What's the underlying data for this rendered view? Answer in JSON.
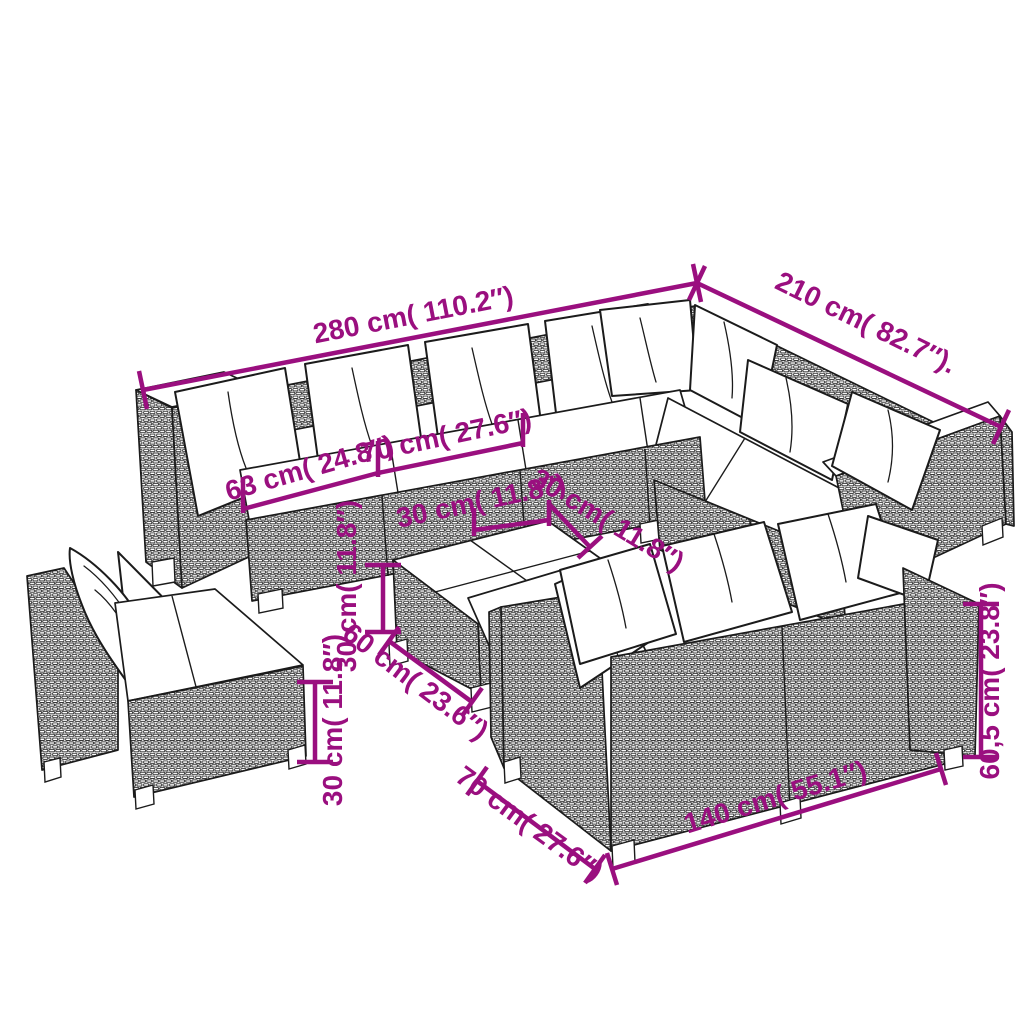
{
  "diagram": {
    "type": "product-dimension-diagram",
    "subject": "garden-lounge-set-poly-rattan",
    "colors": {
      "dimension": "#9a0f7f",
      "outline": "#1b1b1b",
      "cushion": "#ffffff",
      "background": "#ffffff"
    },
    "dims": {
      "total_width": {
        "label": "280 cm( 110.2″)"
      },
      "total_depth": {
        "label": "210 cm( 82.7″)."
      },
      "corner_seat_width": {
        "label": "63 cm( 24.8″)"
      },
      "seat_width": {
        "label": "70 cm( 27.6″)"
      },
      "table_tile_width": {
        "label": "30 cm( 11.8″)"
      },
      "table_tile_depth": {
        "label": "30 cm( 11.8″)"
      },
      "table_height": {
        "label": "30 cm( 11.8″)"
      },
      "table_width": {
        "label": "60 cm( 23.6″)"
      },
      "ottoman_height": {
        "label": "30 cm( 11.8″)"
      },
      "sofa_depth": {
        "label": "70 cm( 27.6″)"
      },
      "sofa_length": {
        "label": "140 cm( 55.1″)"
      },
      "sofa_height": {
        "label": "60,5 cm( 23.8″)"
      }
    }
  }
}
